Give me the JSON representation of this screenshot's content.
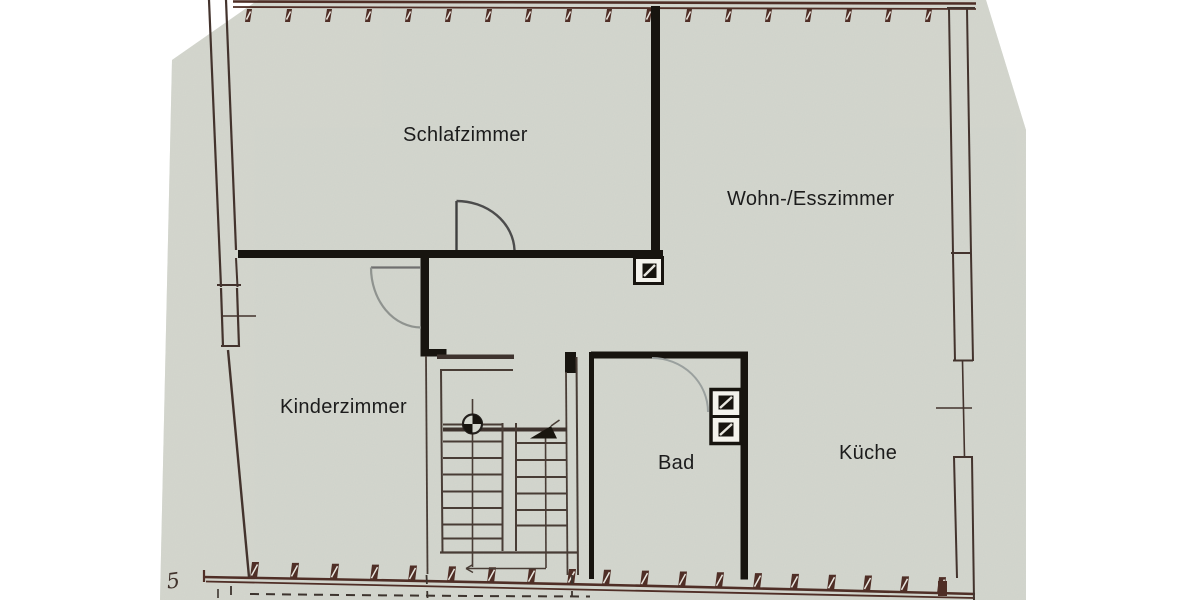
{
  "plan": {
    "rooms": [
      {
        "id": "schlafzimmer",
        "label": "Schlafzimmer"
      },
      {
        "id": "wohn-esszimmer",
        "label": "Wohn-/Esszimmer"
      },
      {
        "id": "kinderzimmer",
        "label": "Kinderzimmer"
      },
      {
        "id": "bad",
        "label": "Bad"
      },
      {
        "id": "kueche",
        "label": "Küche"
      }
    ],
    "margin_note": "5",
    "symbols": [
      {
        "name": "chimney-shaft-icon",
        "location": "wohn-esszimmer"
      },
      {
        "name": "ventilation-shafts-icon",
        "location": "bad"
      },
      {
        "name": "stair-direction-arrow-icon",
        "location": "staircase"
      },
      {
        "name": "stair-newel-circle-icon",
        "location": "staircase"
      }
    ],
    "colors": {
      "paper": "#d4d7cf",
      "margin": "#ffffff",
      "wall": "#17140f",
      "masonry_band": "#4f2e26",
      "thin_line": "#43332d",
      "pencil": "#8f938f",
      "text": "#1c1c1c"
    }
  }
}
